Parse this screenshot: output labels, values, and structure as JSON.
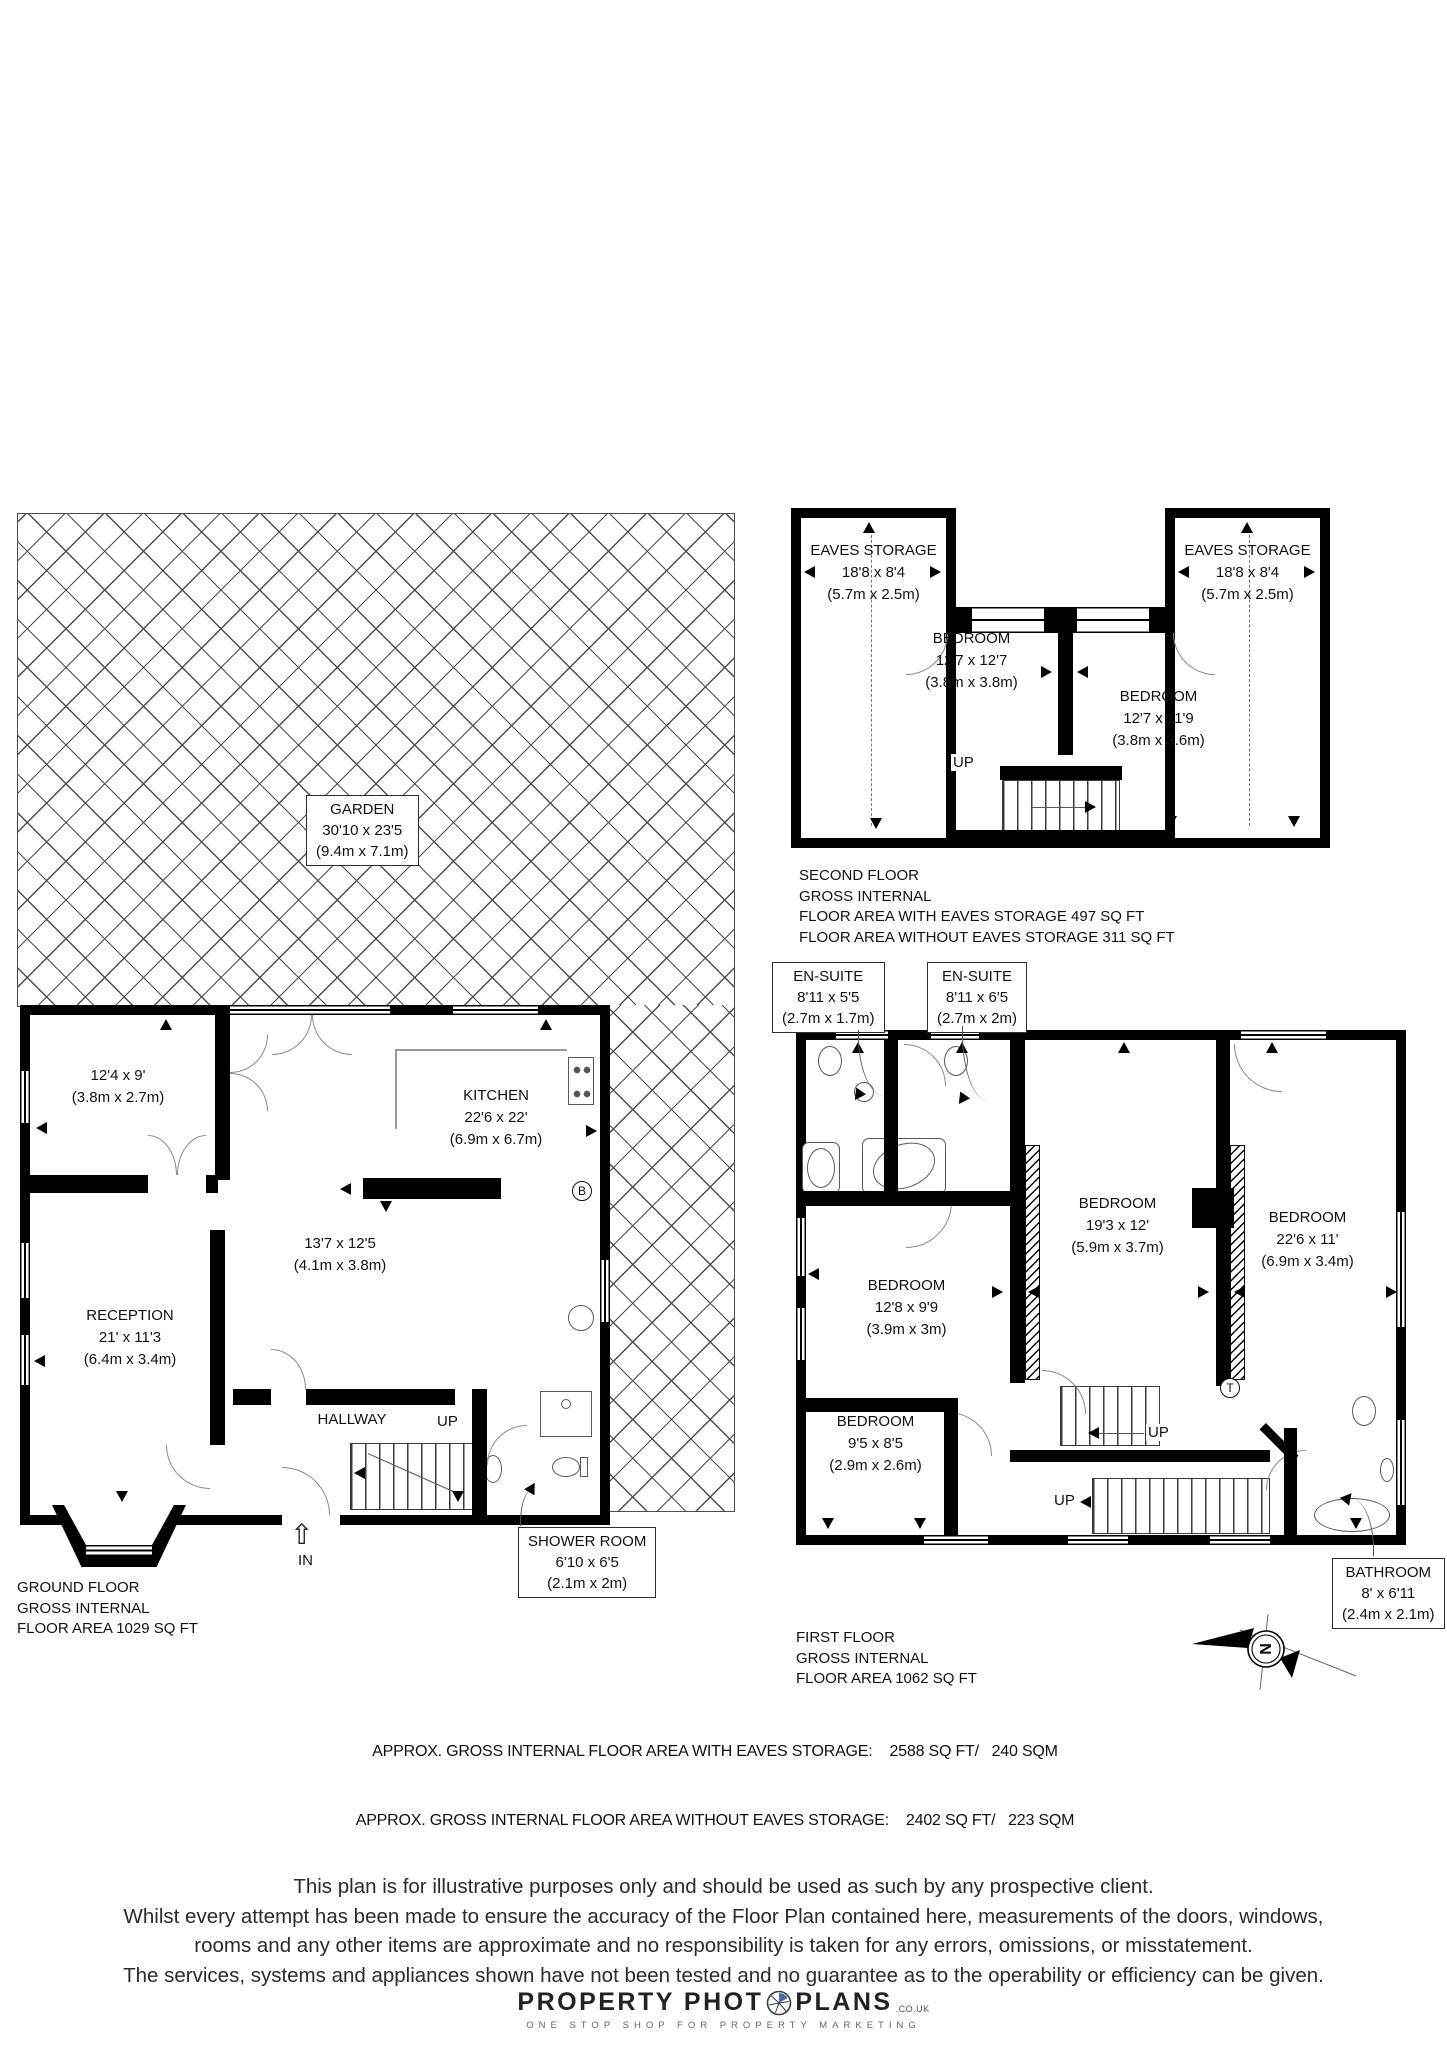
{
  "colors": {
    "wall": "#000000",
    "hatch": "#4d4d4d",
    "accent_blue": "#4a69a5"
  },
  "garden": {
    "name": "GARDEN",
    "dims_ft": "30'10 x 23'5",
    "dims_m": "(9.4m x 7.1m)"
  },
  "second_floor": {
    "eaves_storage_left": {
      "name": "EAVES STORAGE",
      "dims_ft": "18'8 x 8'4",
      "dims_m": "(5.7m x 2.5m)"
    },
    "eaves_storage_right": {
      "name": "EAVES STORAGE",
      "dims_ft": "18'8 x 8'4",
      "dims_m": "(5.7m x 2.5m)"
    },
    "bedroom_1": {
      "name": "BEDROOM",
      "dims_ft": "12'7 x 12'7",
      "dims_m": "(3.8m x 3.8m)"
    },
    "bedroom_2": {
      "name": "BEDROOM",
      "dims_ft": "12'7 x 11'9",
      "dims_m": "(3.8m x 3.6m)"
    },
    "up_label": "UP",
    "info": [
      "SECOND FLOOR",
      "GROSS INTERNAL",
      "FLOOR AREA WITH EAVES STORAGE 497 SQ FT",
      "FLOOR AREA WITHOUT EAVES STORAGE 311 SQ FT"
    ]
  },
  "first_floor": {
    "ensuite_1": {
      "name": "EN-SUITE",
      "dims_ft": "8'11 x 5'5",
      "dims_m": "(2.7m x 1.7m)"
    },
    "ensuite_2": {
      "name": "EN-SUITE",
      "dims_ft": "8'11 x 6'5",
      "dims_m": "(2.7m x 2m)"
    },
    "bedroom_19": {
      "name": "BEDROOM",
      "dims_ft": "19'3 x 12'",
      "dims_m": "(5.9m x 3.7m)"
    },
    "bedroom_22": {
      "name": "BEDROOM",
      "dims_ft": "22'6 x 11'",
      "dims_m": "(6.9m x 3.4m)"
    },
    "bedroom_12": {
      "name": "BEDROOM",
      "dims_ft": "12'8 x 9'9",
      "dims_m": "(3.9m x 3m)"
    },
    "bedroom_9": {
      "name": "BEDROOM",
      "dims_ft": "9'5 x 8'5",
      "dims_m": "(2.9m x 2.6m)"
    },
    "bathroom": {
      "name": "BATHROOM",
      "dims_ft": "8' x 6'11",
      "dims_m": "(2.4m x 2.1m)"
    },
    "up_label_1": "UP",
    "up_label_2": "UP",
    "t_label": "T",
    "info": [
      "FIRST FLOOR",
      "GROSS INTERNAL",
      "FLOOR AREA 1062 SQ FT"
    ]
  },
  "ground_floor": {
    "room_front": {
      "dims_ft": "12'4 x 9'",
      "dims_m": "(3.8m x 2.7m)"
    },
    "kitchen": {
      "name": "KITCHEN",
      "dims_ft": "22'6 x 22'",
      "dims_m": "(6.9m x 6.7m)"
    },
    "room_middle": {
      "dims_ft": "13'7 x 12'5",
      "dims_m": "(4.1m x 3.8m)"
    },
    "reception": {
      "name": "RECEPTION",
      "dims_ft": "21' x 11'3",
      "dims_m": "(6.4m x 3.4m)"
    },
    "hallway": {
      "name": "HALLWAY"
    },
    "shower_room": {
      "name": "SHOWER ROOM",
      "dims_ft": "6'10 x 6'5",
      "dims_m": "(2.1m x 2m)"
    },
    "up_label": "UP",
    "in_label": "IN",
    "b_label": "B",
    "info": [
      "GROUND FLOOR",
      "GROSS INTERNAL",
      "FLOOR AREA 1029 SQ FT"
    ]
  },
  "summary": [
    "APPROX. GROSS INTERNAL FLOOR AREA WITH EAVES STORAGE:    2588 SQ FT/   240 SQM",
    "APPROX. GROSS INTERNAL FLOOR AREA WITHOUT EAVES STORAGE:    2402 SQ FT/   223 SQM"
  ],
  "disclaimer": [
    "This plan is for illustrative purposes only and should be used as such by any prospective client.",
    "Whilst every attempt has been made to ensure the accuracy of the Floor Plan contained here, measurements of the doors, windows,",
    "rooms and any other items are approximate and no responsibility is taken for any errors, omissions, or misstatement.",
    "The services, systems and appliances shown have not been tested and no guarantee as to the operability or efficiency can be given."
  ],
  "logo": {
    "part1": "PROPERTY PHOT",
    "part2": "PLANS",
    "suffix": ".CO.UK",
    "tagline": "ONE STOP SHOP FOR PROPERTY MARKETING"
  },
  "compass": {
    "north_label": "N"
  }
}
